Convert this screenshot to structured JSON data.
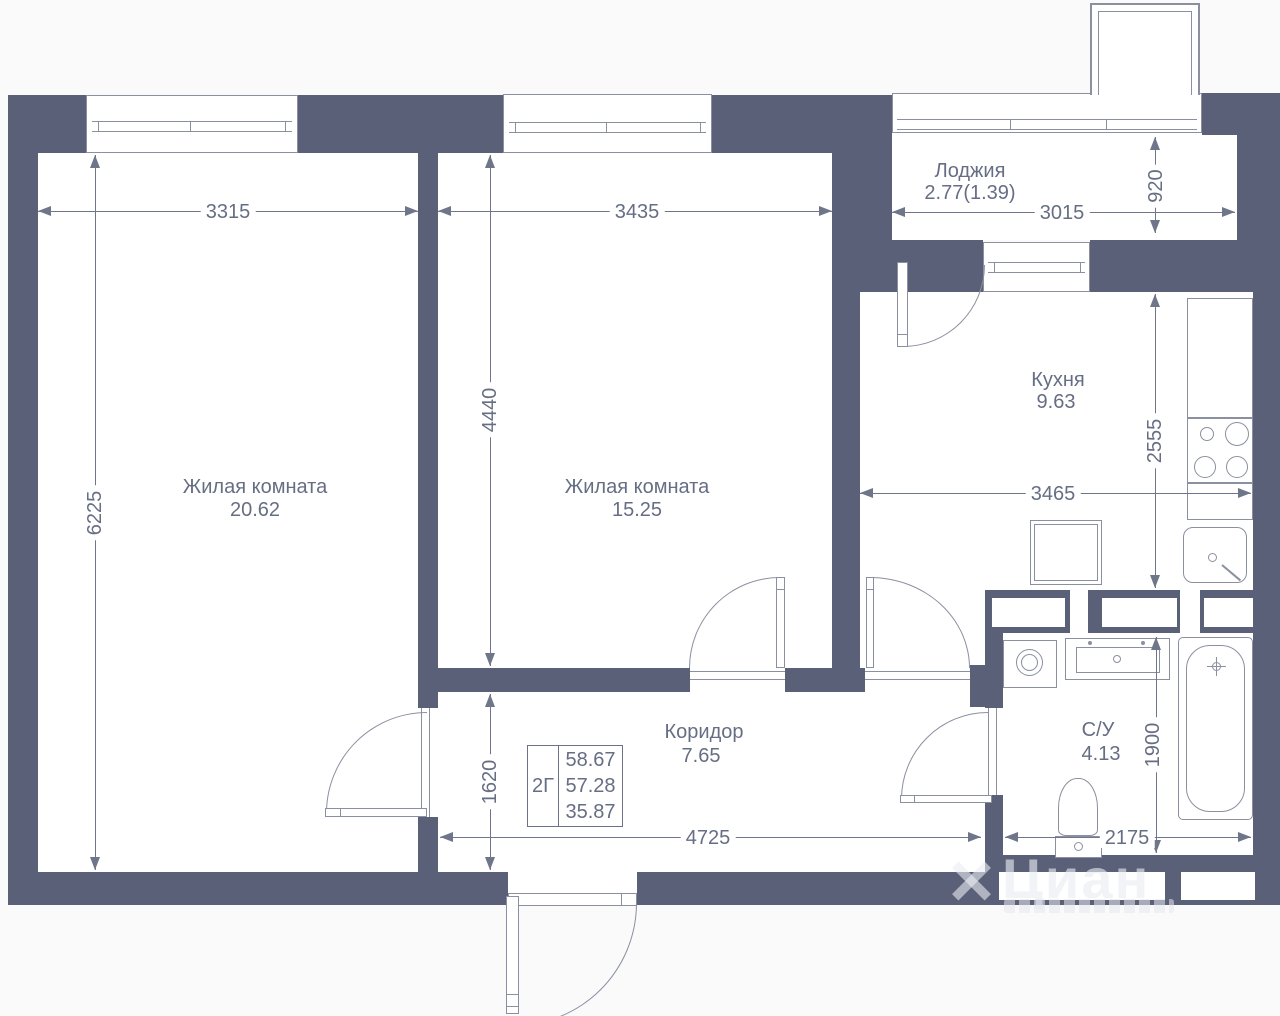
{
  "colors": {
    "wall": "#5a6078",
    "outline": "#8b90a0",
    "dimension_line": "#70768a",
    "text": "#666e84",
    "floor": "#ffffff",
    "background": "#fafafb",
    "watermark": "#e9ebf1"
  },
  "rooms": [
    {
      "name": "Жилая комната",
      "area": "20.62"
    },
    {
      "name": "Жилая комната",
      "area": "15.25"
    },
    {
      "name": "Кухня",
      "area": "9.63"
    },
    {
      "name": "Коридор",
      "area": "7.65"
    },
    {
      "name": "С/У",
      "area": "4.13"
    },
    {
      "name": "Лоджия",
      "area": "2.77(1.39)"
    }
  ],
  "dimensions": {
    "d3315": "3315",
    "d3435": "3435",
    "d3015": "3015",
    "d920": "920",
    "d6225": "6225",
    "d4440": "4440",
    "d2555": "2555",
    "d3465": "3465",
    "d1620": "1620",
    "d4725": "4725",
    "d1900": "1900",
    "d2175": "2175"
  },
  "info_table": {
    "plan_type": "2Г",
    "rows": [
      "58.67",
      "57.28",
      "35.87"
    ]
  },
  "watermark": {
    "brand": "Циан"
  }
}
